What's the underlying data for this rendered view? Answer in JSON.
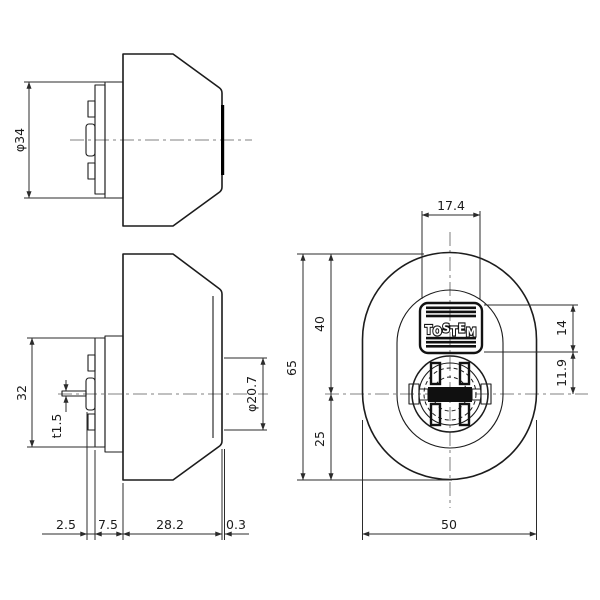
{
  "canvas": {
    "width": 600,
    "height": 600,
    "background": "#ffffff"
  },
  "colors": {
    "outline": "#1c1c1c",
    "dimension_line": "#2b2b2b",
    "centerline": "#9a9a9a",
    "dark_fill": "#101010",
    "logo_letter_fill": "#ffffff"
  },
  "top_view": {
    "diameter": "φ34"
  },
  "side_view": {
    "plate_height": "32",
    "tailpiece_thickness": "t1.5",
    "front_diameter": "φ20.7",
    "clip_offset": "2.5",
    "plate_depth": "7.5",
    "body_depth": "28.2",
    "face_lip": "0.3"
  },
  "front_view": {
    "logo": "TOSTEM",
    "logo_width": "17.4",
    "upper_height": "40",
    "total_height": "65",
    "lower_height": "25",
    "logo_height": "14",
    "logo_to_center": "11.9",
    "width": "50"
  }
}
